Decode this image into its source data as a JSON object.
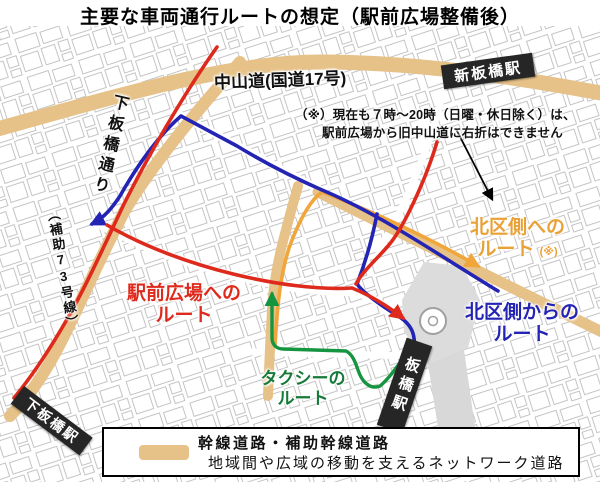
{
  "title": "主要な車両通行ルートの想定（駅前広場整備後）",
  "map": {
    "road_color": "#e6c288",
    "roads": {
      "nakasendo": "中山道(国道17号)",
      "shimoitabashi_dori": "下板橋通り",
      "hojo73": "（補助73号線）"
    },
    "stations": {
      "shin_itabashi": "新板橋駅",
      "itabashi": "板橋駅",
      "shimo_itabashi": "下板橋駅"
    },
    "note": {
      "line1": "（※）現在も７時～20時（日曜・休日除く）は、",
      "line2": "駅前広場から旧中山道に右折はできません"
    },
    "routes": {
      "to_plaza": {
        "line1": "駅前広場への",
        "line2": "ルート",
        "color": "#dd2a1c"
      },
      "from_kita": {
        "line1": "北区側からの",
        "line2": "ルート",
        "color": "#2323b4"
      },
      "to_kita": {
        "line1": "北区側への",
        "line2": "ルート",
        "note_mark": "(※)",
        "color": "#f0a63a"
      },
      "taxi": {
        "line1": "タクシーの",
        "line2": "ルート",
        "color": "#169540"
      }
    }
  },
  "legend": {
    "line1": "幹線道路・補助幹線道路",
    "line2": "地域間や広域の移動を支えるネットワーク道路"
  }
}
